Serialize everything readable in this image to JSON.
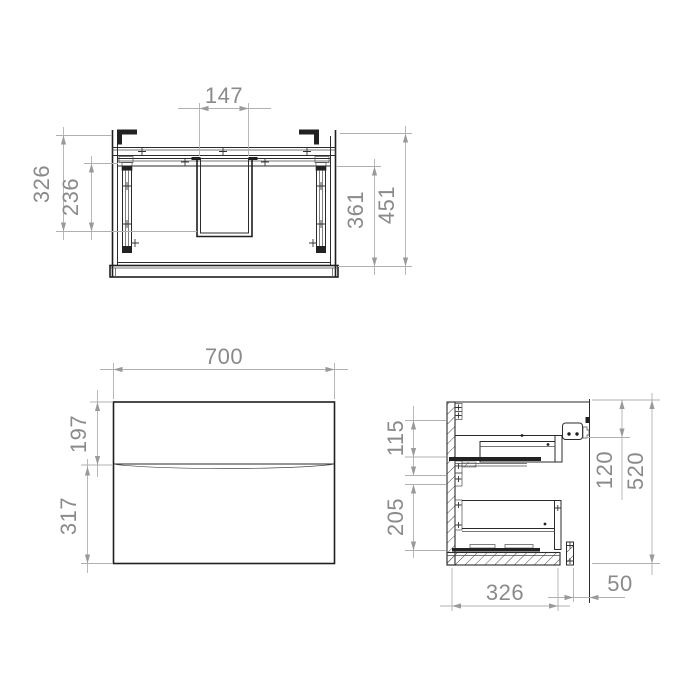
{
  "page": {
    "title": "Wall-hung vanity cabinet technical drawing",
    "background": "#ffffff"
  },
  "colors": {
    "drawing_line": "#2b2b2b",
    "dimension_line": "#b0b0b0",
    "dimension_text": "#8a8a8a",
    "bracket_fill": "#222222"
  },
  "views": {
    "rear_section": {
      "name": "rear section view (top)",
      "dimensions": {
        "cutout_width": "147",
        "left_overall": "326",
        "left_inner": "236",
        "right_inner": "361",
        "right_overall": "451"
      }
    },
    "front": {
      "name": "front view (bottom left)",
      "dimensions": {
        "overall_width": "700",
        "top_drawer_height": "197",
        "bottom_drawer_height": "317"
      }
    },
    "side_section": {
      "name": "side section view (bottom right)",
      "dimensions": {
        "upper_left": "115",
        "lower_left": "205",
        "right_inner": "120",
        "overall_height": "520",
        "bottom_depth": "326",
        "wall_clearance": "50"
      }
    }
  }
}
